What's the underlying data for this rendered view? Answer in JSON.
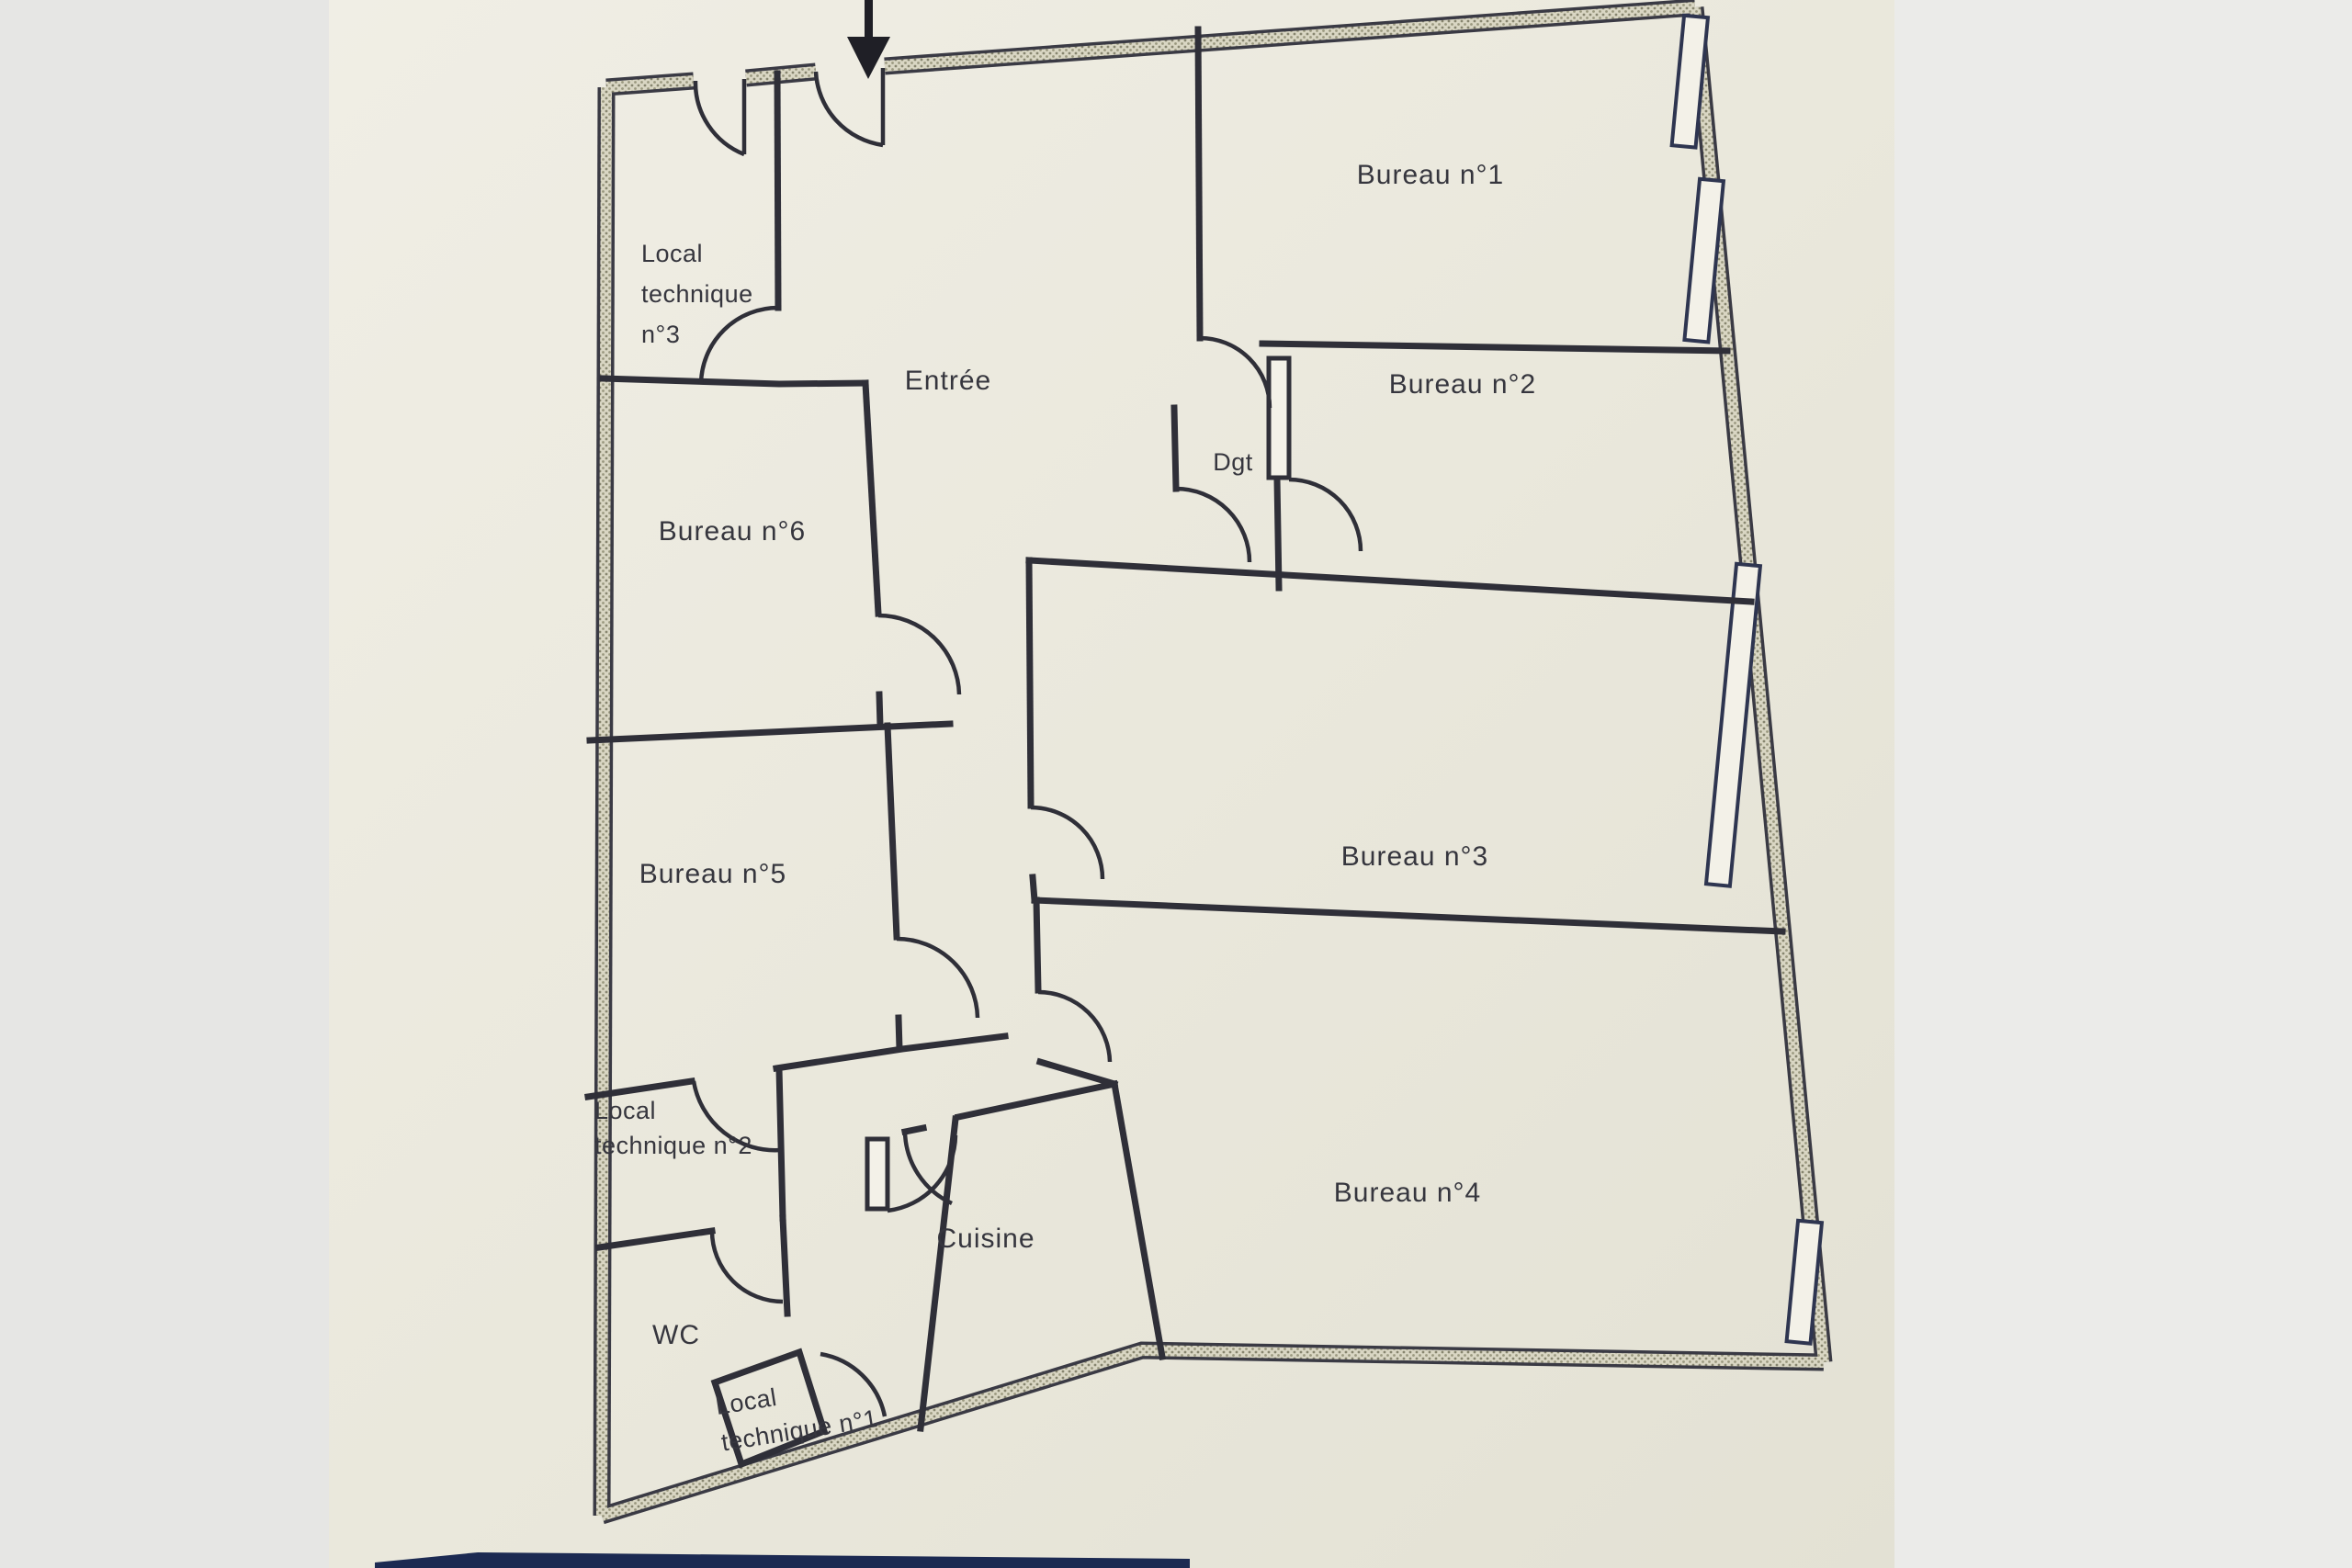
{
  "document": {
    "kind": "scanned floor plan photo",
    "language": "fr",
    "entrance_marker": "black arrow pointing down at entry door"
  },
  "palette": {
    "paper": "#edebe0",
    "paper_dark": "#e2e0d4",
    "margin_left": "#e6e6e4",
    "margin_right": "#ebebe9",
    "ink": "#34343c",
    "wall_core": "#d9d6c3",
    "navy_band": "#1c2a52",
    "window_fill": "#f3f1e8"
  },
  "labels": {
    "entree": "Entrée",
    "bureau1": "Bureau n°1",
    "bureau2": "Bureau n°2",
    "bureau3": "Bureau n°3",
    "bureau4": "Bureau n°4",
    "bureau5": "Bureau n°5",
    "bureau6": "Bureau n°6",
    "dgt": "Dgt",
    "wc": "WC",
    "cuisine": "Cuisine",
    "lt3_1": "Local",
    "lt3_2": "technique",
    "lt3_3": "n°3",
    "lt2_1": "Local",
    "lt2_2": "technique n°2",
    "lt1_1": "Local",
    "lt1_2": "technique n°1"
  },
  "rooms": [
    {
      "id": "entree",
      "label": "Entrée"
    },
    {
      "id": "bureau1",
      "label": "Bureau n°1"
    },
    {
      "id": "bureau2",
      "label": "Bureau n°2"
    },
    {
      "id": "dgt",
      "label": "Dgt"
    },
    {
      "id": "bureau3",
      "label": "Bureau n°3"
    },
    {
      "id": "bureau4",
      "label": "Bureau n°4"
    },
    {
      "id": "bureau6",
      "label": "Bureau n°6"
    },
    {
      "id": "bureau5",
      "label": "Bureau n°5"
    },
    {
      "id": "lt3",
      "label": "Local technique n°3"
    },
    {
      "id": "lt2",
      "label": "Local technique n°2"
    },
    {
      "id": "wc",
      "label": "WC"
    },
    {
      "id": "lt1",
      "label": "Local technique n°1"
    },
    {
      "id": "cuisine",
      "label": "Cuisine"
    }
  ],
  "openings": {
    "windows_right_wall": 4,
    "entry_door": 1,
    "interior_doors": 13
  }
}
